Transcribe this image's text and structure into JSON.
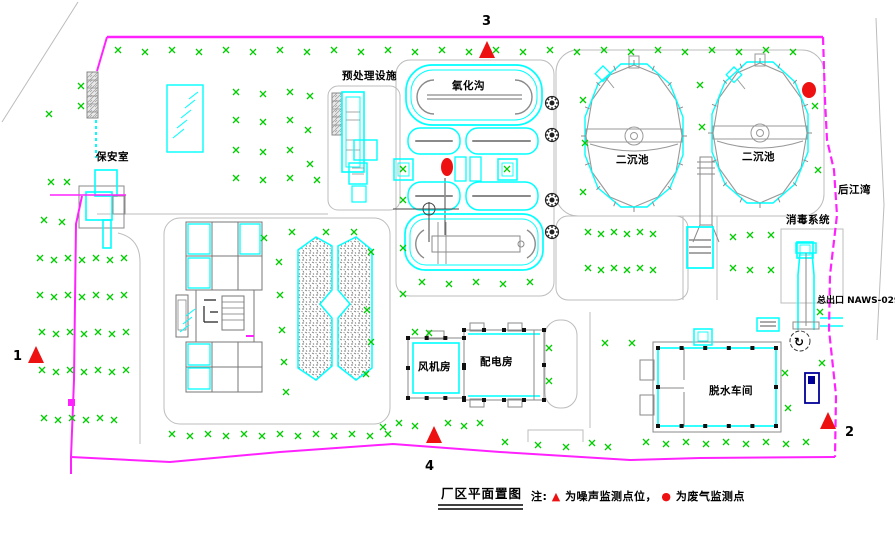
{
  "drawing": {
    "title": "厂区平面置图",
    "note_prefix": "注:",
    "note_noise_symbol": "▲",
    "note_noise_text": "为噪声监测点位，",
    "note_gas_symbol": "●",
    "note_gas_text": "为废气监测点"
  },
  "labels": {
    "security_room": "保安室",
    "pretreatment": "预处理设施",
    "oxidation_ditch": "氧化沟",
    "sedimentation_tank_1": "二沉池",
    "sedimentation_tank_2": "二沉池",
    "disinfection_system": "消毒系统",
    "river": "后江湾",
    "main_outlet": "总出口 NAWS-029",
    "blower_room": "风机房",
    "power_room": "配电房",
    "dewatering_workshop": "脱水车间"
  },
  "icons": {
    "pump": "↻"
  },
  "monitoring": {
    "noise_points": [
      {
        "label": "1",
        "x": 36,
        "y": 355,
        "lx": 13,
        "ly": 360
      },
      {
        "label": "2",
        "x": 828,
        "y": 421,
        "lx": 845,
        "ly": 436
      },
      {
        "label": "3",
        "x": 487,
        "y": 50,
        "lx": 482,
        "ly": 25
      },
      {
        "label": "4",
        "x": 434,
        "y": 435,
        "lx": 425,
        "ly": 470
      }
    ],
    "gas_points": [
      {
        "x": 447,
        "y": 167,
        "rx": 6,
        "ry": 9
      },
      {
        "x": 809,
        "y": 90,
        "rx": 7,
        "ry": 8
      }
    ]
  },
  "tanks": [
    {
      "cx": 634,
      "cy": 136,
      "rx": 48,
      "ry": 71
    },
    {
      "cx": 760,
      "cy": 133,
      "rx": 47,
      "ry": 70
    }
  ],
  "gears": [
    [
      552,
      103
    ],
    [
      552,
      135
    ],
    [
      552,
      200
    ],
    [
      552,
      232
    ]
  ],
  "column_buildings": [
    {
      "x": 408,
      "y": 338,
      "w": 56,
      "h": 60,
      "n": 3
    },
    {
      "x": 464,
      "y": 330,
      "w": 80,
      "h": 70,
      "n": 4
    },
    {
      "x": 658,
      "y": 348,
      "w": 118,
      "h": 78,
      "n": 5
    }
  ],
  "vegetation": {
    "rows": [
      {
        "y": 50,
        "x0": 118,
        "x1": 799,
        "step": 27
      },
      {
        "y": 220,
        "x0": 44,
        "x1": 66,
        "step": 18
      },
      {
        "y": 258,
        "x0": 40,
        "x1": 128,
        "step": 14
      },
      {
        "y": 295,
        "x0": 40,
        "x1": 130,
        "step": 14
      },
      {
        "y": 332,
        "x0": 42,
        "x1": 130,
        "step": 14
      },
      {
        "y": 370,
        "x0": 42,
        "x1": 130,
        "step": 14
      },
      {
        "y": 418,
        "x0": 44,
        "x1": 126,
        "step": 14
      },
      {
        "y": 92,
        "x0": 236,
        "x1": 292,
        "step": 27
      },
      {
        "y": 120,
        "x0": 236,
        "x1": 292,
        "step": 27
      },
      {
        "y": 150,
        "x0": 236,
        "x1": 292,
        "step": 27
      },
      {
        "y": 178,
        "x0": 236,
        "x1": 320,
        "step": 27
      },
      {
        "y": 282,
        "x0": 422,
        "x1": 533,
        "step": 27
      },
      {
        "y": 232,
        "x0": 588,
        "x1": 664,
        "step": 13
      },
      {
        "y": 268,
        "x0": 588,
        "x1": 664,
        "step": 13
      },
      {
        "y": 434,
        "x0": 172,
        "x1": 392,
        "step": 18
      },
      {
        "y": 442,
        "x0": 646,
        "x1": 818,
        "step": 20
      }
    ],
    "singles": [
      [
        49,
        114
      ],
      [
        81,
        86
      ],
      [
        81,
        106
      ],
      [
        51,
        182
      ],
      [
        67,
        182
      ],
      [
        310,
        96
      ],
      [
        308,
        130
      ],
      [
        310,
        164
      ],
      [
        264,
        238
      ],
      [
        292,
        232
      ],
      [
        326,
        232
      ],
      [
        354,
        232
      ],
      [
        279,
        262
      ],
      [
        371,
        252
      ],
      [
        367,
        310
      ],
      [
        371,
        342
      ],
      [
        366,
        374
      ],
      [
        280,
        295
      ],
      [
        282,
        330
      ],
      [
        284,
        362
      ],
      [
        286,
        392
      ],
      [
        403,
        200
      ],
      [
        403,
        248
      ],
      [
        403,
        294
      ],
      [
        583,
        100
      ],
      [
        585,
        143
      ],
      [
        583,
        192
      ],
      [
        700,
        85
      ],
      [
        702,
        127
      ],
      [
        815,
        106
      ],
      [
        818,
        170
      ],
      [
        733,
        237
      ],
      [
        733,
        268
      ],
      [
        750,
        235
      ],
      [
        771,
        235
      ],
      [
        750,
        270
      ],
      [
        771,
        270
      ],
      [
        820,
        312
      ],
      [
        415,
        332
      ],
      [
        429,
        333
      ],
      [
        549,
        348
      ],
      [
        549,
        381
      ],
      [
        605,
        343
      ],
      [
        632,
        343
      ],
      [
        785,
        373
      ],
      [
        788,
        408
      ],
      [
        822,
        363
      ],
      [
        383,
        427
      ],
      [
        399,
        423
      ],
      [
        415,
        426
      ],
      [
        448,
        423
      ],
      [
        464,
        426
      ],
      [
        480,
        423
      ],
      [
        505,
        442
      ],
      [
        538,
        445
      ],
      [
        566,
        447
      ],
      [
        592,
        443
      ],
      [
        608,
        447
      ],
      [
        403,
        169
      ],
      [
        507,
        169
      ]
    ]
  },
  "colors": {
    "boundary": "#ff22ff",
    "structure": "#00ffff",
    "vegetation": "#00cc00",
    "marker": "#ee1111",
    "road": "#bcbcbc",
    "wall": "#8a8a8a",
    "navy": "#000099"
  }
}
